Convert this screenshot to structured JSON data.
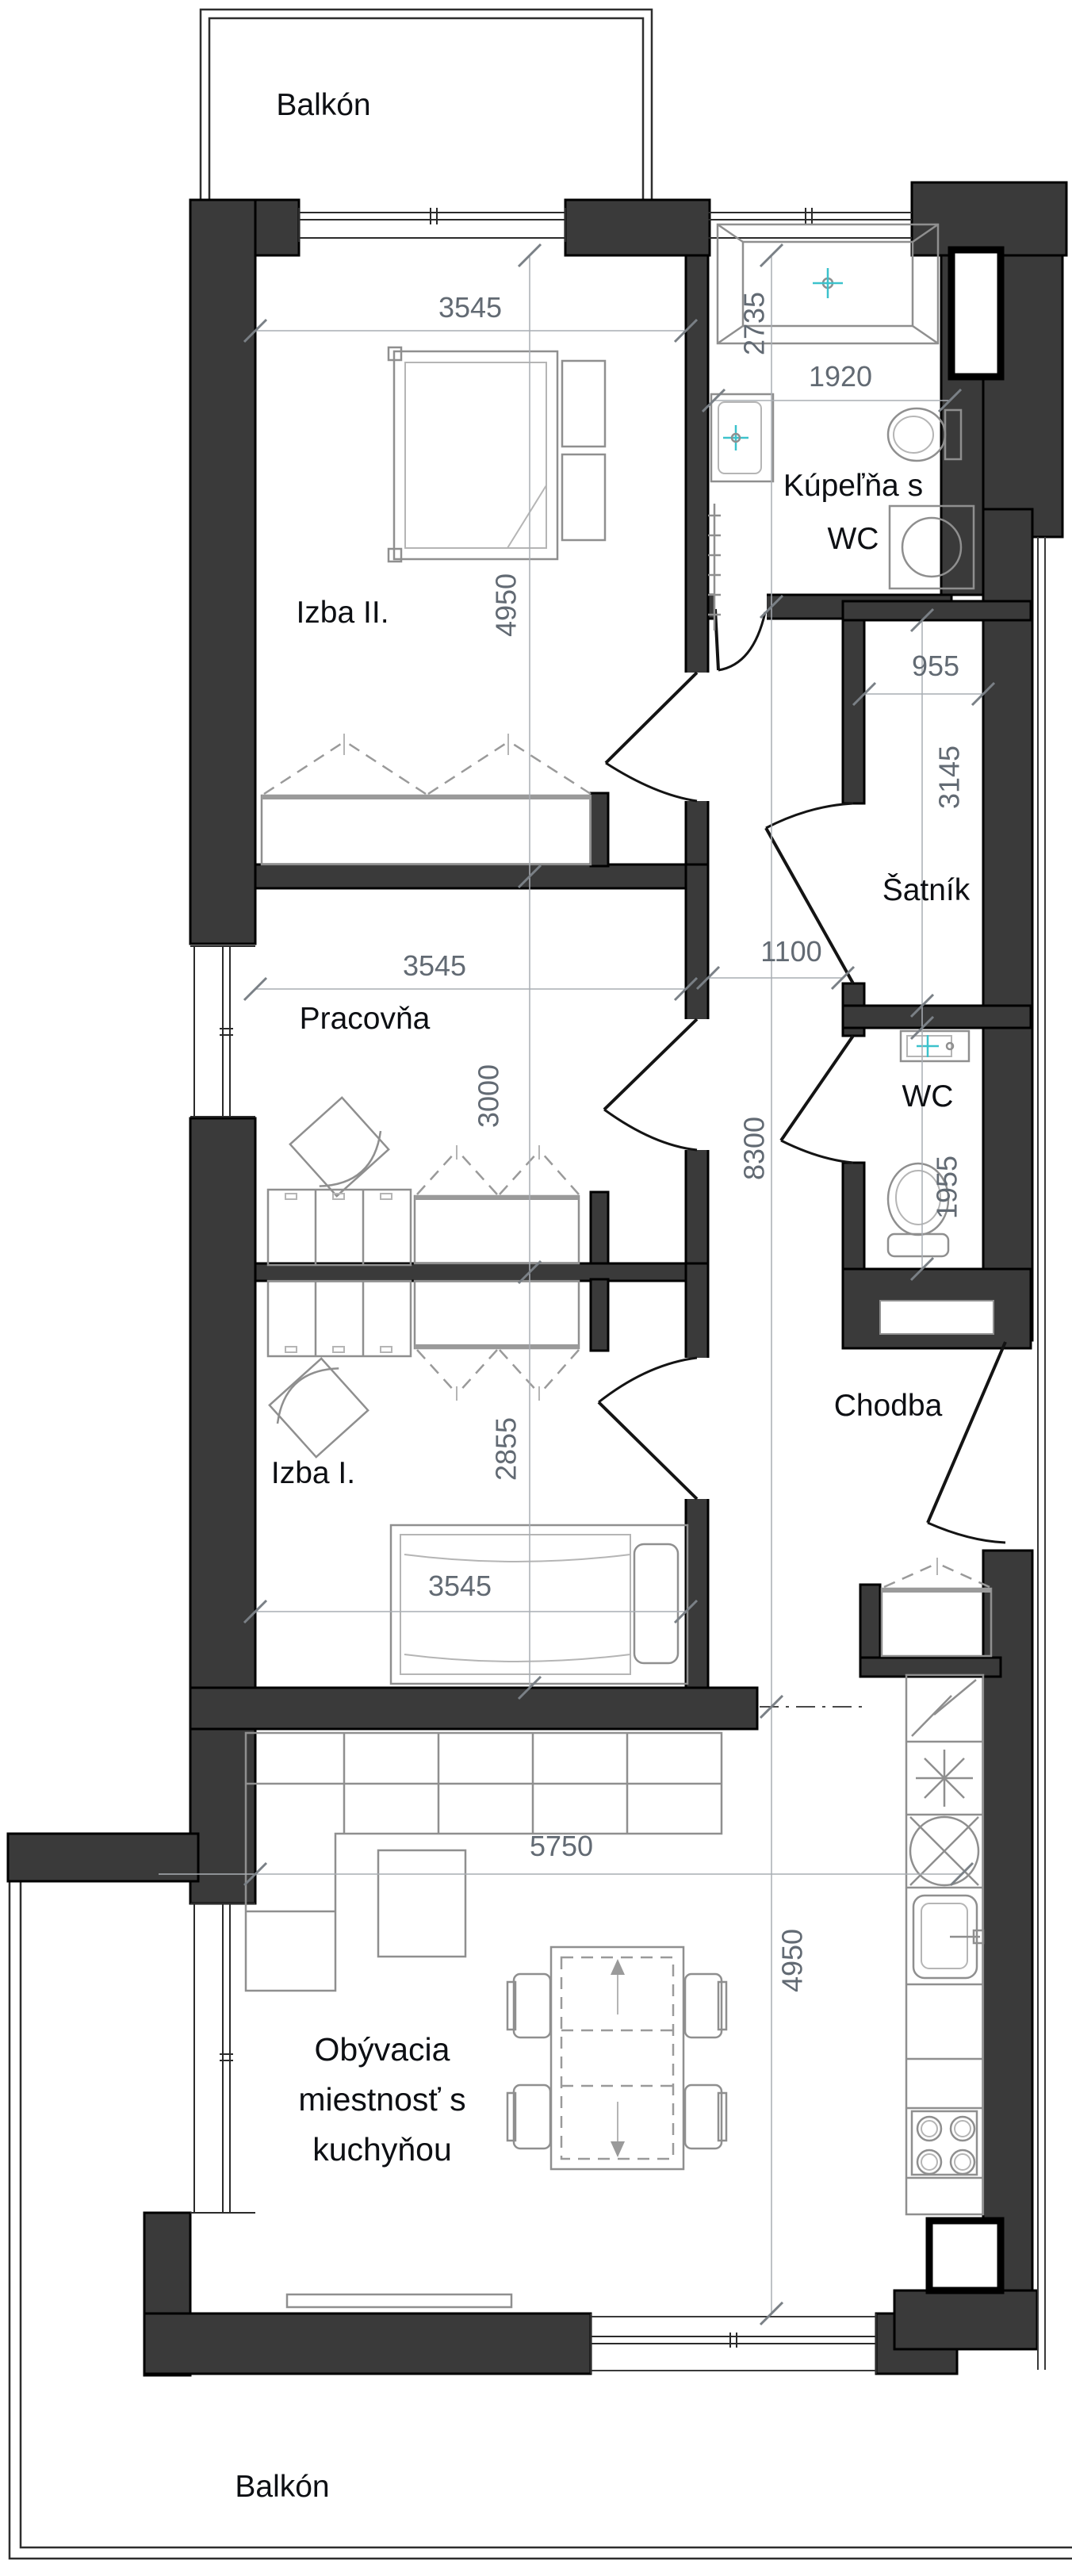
{
  "plan": {
    "type": "apartment-floor-plan",
    "language": "sk"
  },
  "rooms": {
    "balkon_top": {
      "label": "Balkón"
    },
    "izba2": {
      "label": "Izba II."
    },
    "kupelna": {
      "line1": "Kúpeľňa s",
      "line2": "WC"
    },
    "satnik": {
      "label": "Šatník"
    },
    "pracovna": {
      "label": "Pracovňa"
    },
    "wc": {
      "label": "WC"
    },
    "chodba": {
      "label": "Chodba"
    },
    "izba1": {
      "label": "Izba I."
    },
    "obyvacia": {
      "line1": "Obývacia",
      "line2": "miestnosť s",
      "line3": "kuchyňou"
    },
    "balkon_bottom": {
      "label": "Balkón"
    }
  },
  "dimensions_mm": {
    "izba2_width": "3545",
    "kupelna_height": "2735",
    "kupelna_width": "1920",
    "izba2_height": "4950",
    "satnik_width": "955",
    "satnik_height": "3145",
    "pracovna_width": "3545",
    "chodba_width": "1100",
    "pracovna_height": "3000",
    "chodba_height": "8300",
    "wc_height": "1955",
    "izba1_height": "2855",
    "izba1_width": "3545",
    "obyvacia_width": "5750",
    "obyvacia_height": "4950"
  },
  "colors": {
    "wall": "#3a3a3a",
    "background": "#ffffff",
    "dimension_text": "#626a73",
    "room_label": "#0d0f13",
    "furniture": "#8f8f8f",
    "fixture_accent": "#3cc2cc"
  }
}
